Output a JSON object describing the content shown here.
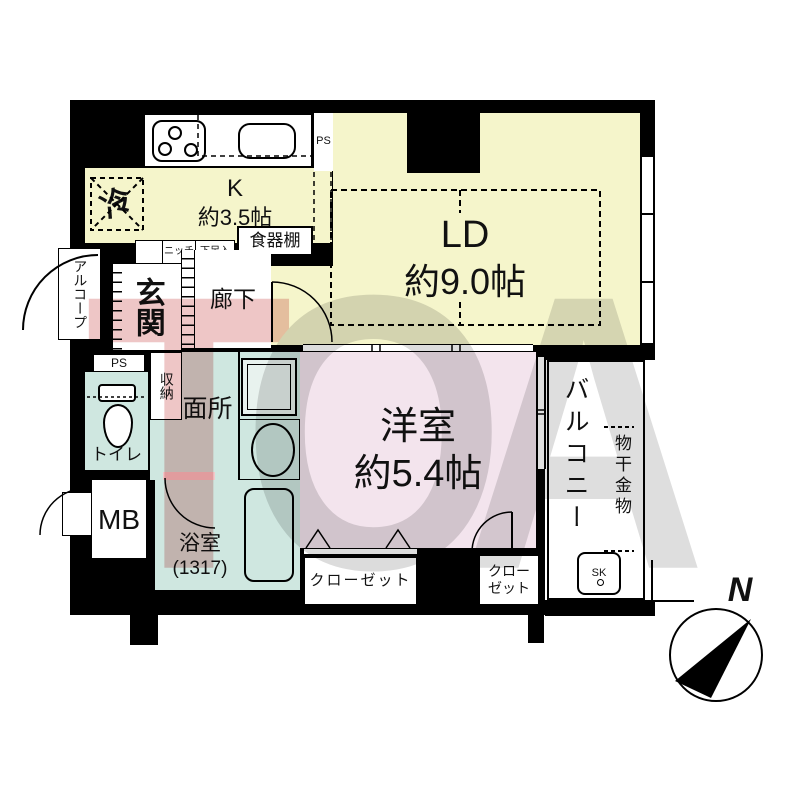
{
  "labels": {
    "rei": "冷",
    "kitchen": "K",
    "kitchen_size": "約3.5帖",
    "ps_top": "PS",
    "ld": "LD",
    "ld_size": "約9.0帖",
    "cupboard": "食器棚",
    "niche": "ニッチ",
    "shoe": "下足入",
    "alcove": "アルコープ",
    "entrance": "玄関",
    "hallway": "廊下",
    "ps_left": "PS",
    "storage": "収納",
    "toilet": "トイレ",
    "washroom": "洗面所",
    "mb": "MB",
    "bath": "浴室",
    "bath_size": "(1317)",
    "western": "洋室",
    "western_size": "約5.4帖",
    "closet1": "クローゼット",
    "closet2a": "クロー",
    "closet2b": "ゼット",
    "balcony": "バルコニー",
    "laundry": "物干金物",
    "sk": "SK",
    "north": "N"
  },
  "watermark": {
    "letter1": "T",
    "letter2": "O",
    "letter3": "A"
  },
  "colors": {
    "wall": "#000000",
    "kitchen_living": "#f5f5cb",
    "western_room": "#f3e4ed",
    "wet_area": "#cfe7e0",
    "threshold": "#f2c9cb",
    "watermark_t": "#eec6c6",
    "watermark_oa": "#dcdcdc"
  }
}
